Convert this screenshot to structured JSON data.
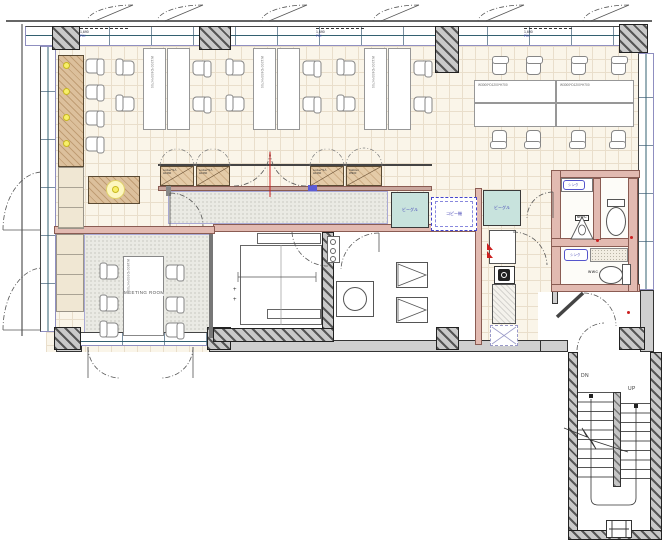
{
  "labels": {
    "meeting_room": "MEETING ROOM",
    "meeting_table_dim": "W1800*D900*H700",
    "desk_dim_small": "W1200*D600*H700",
    "desk_dim_large": "W3000*D1200*H700",
    "locker_line1": "Locker*9人",
    "locker_line2": "H1060",
    "cabinet_line1": "Cabinet",
    "cabinet_line2": "W900",
    "shelf_unit": "ビーグル",
    "copier": "コピー機",
    "sink": "シンク",
    "mens_wc": "MWC",
    "womens_wc": "WWC",
    "stair_down": "DN",
    "stair_up": "UP",
    "window_dim": "1,690",
    "window_fix": "FIX",
    "plus_mark": "+"
  },
  "colors": {
    "floor_tile": "#faf5e9",
    "tile_grid": "#e9decb",
    "stipple_floor": "#eaeae4",
    "wood": "#dcc09c",
    "pink_wall": "#e2bab1",
    "teal_cabinet": "#c8e3dd",
    "window_frame_blue": "#8f8fc0",
    "glazing": "#336070",
    "annotation_blue": "#3f3fb4",
    "accent_red": "#cc2020",
    "light_yellow": "#f7ef6a"
  }
}
